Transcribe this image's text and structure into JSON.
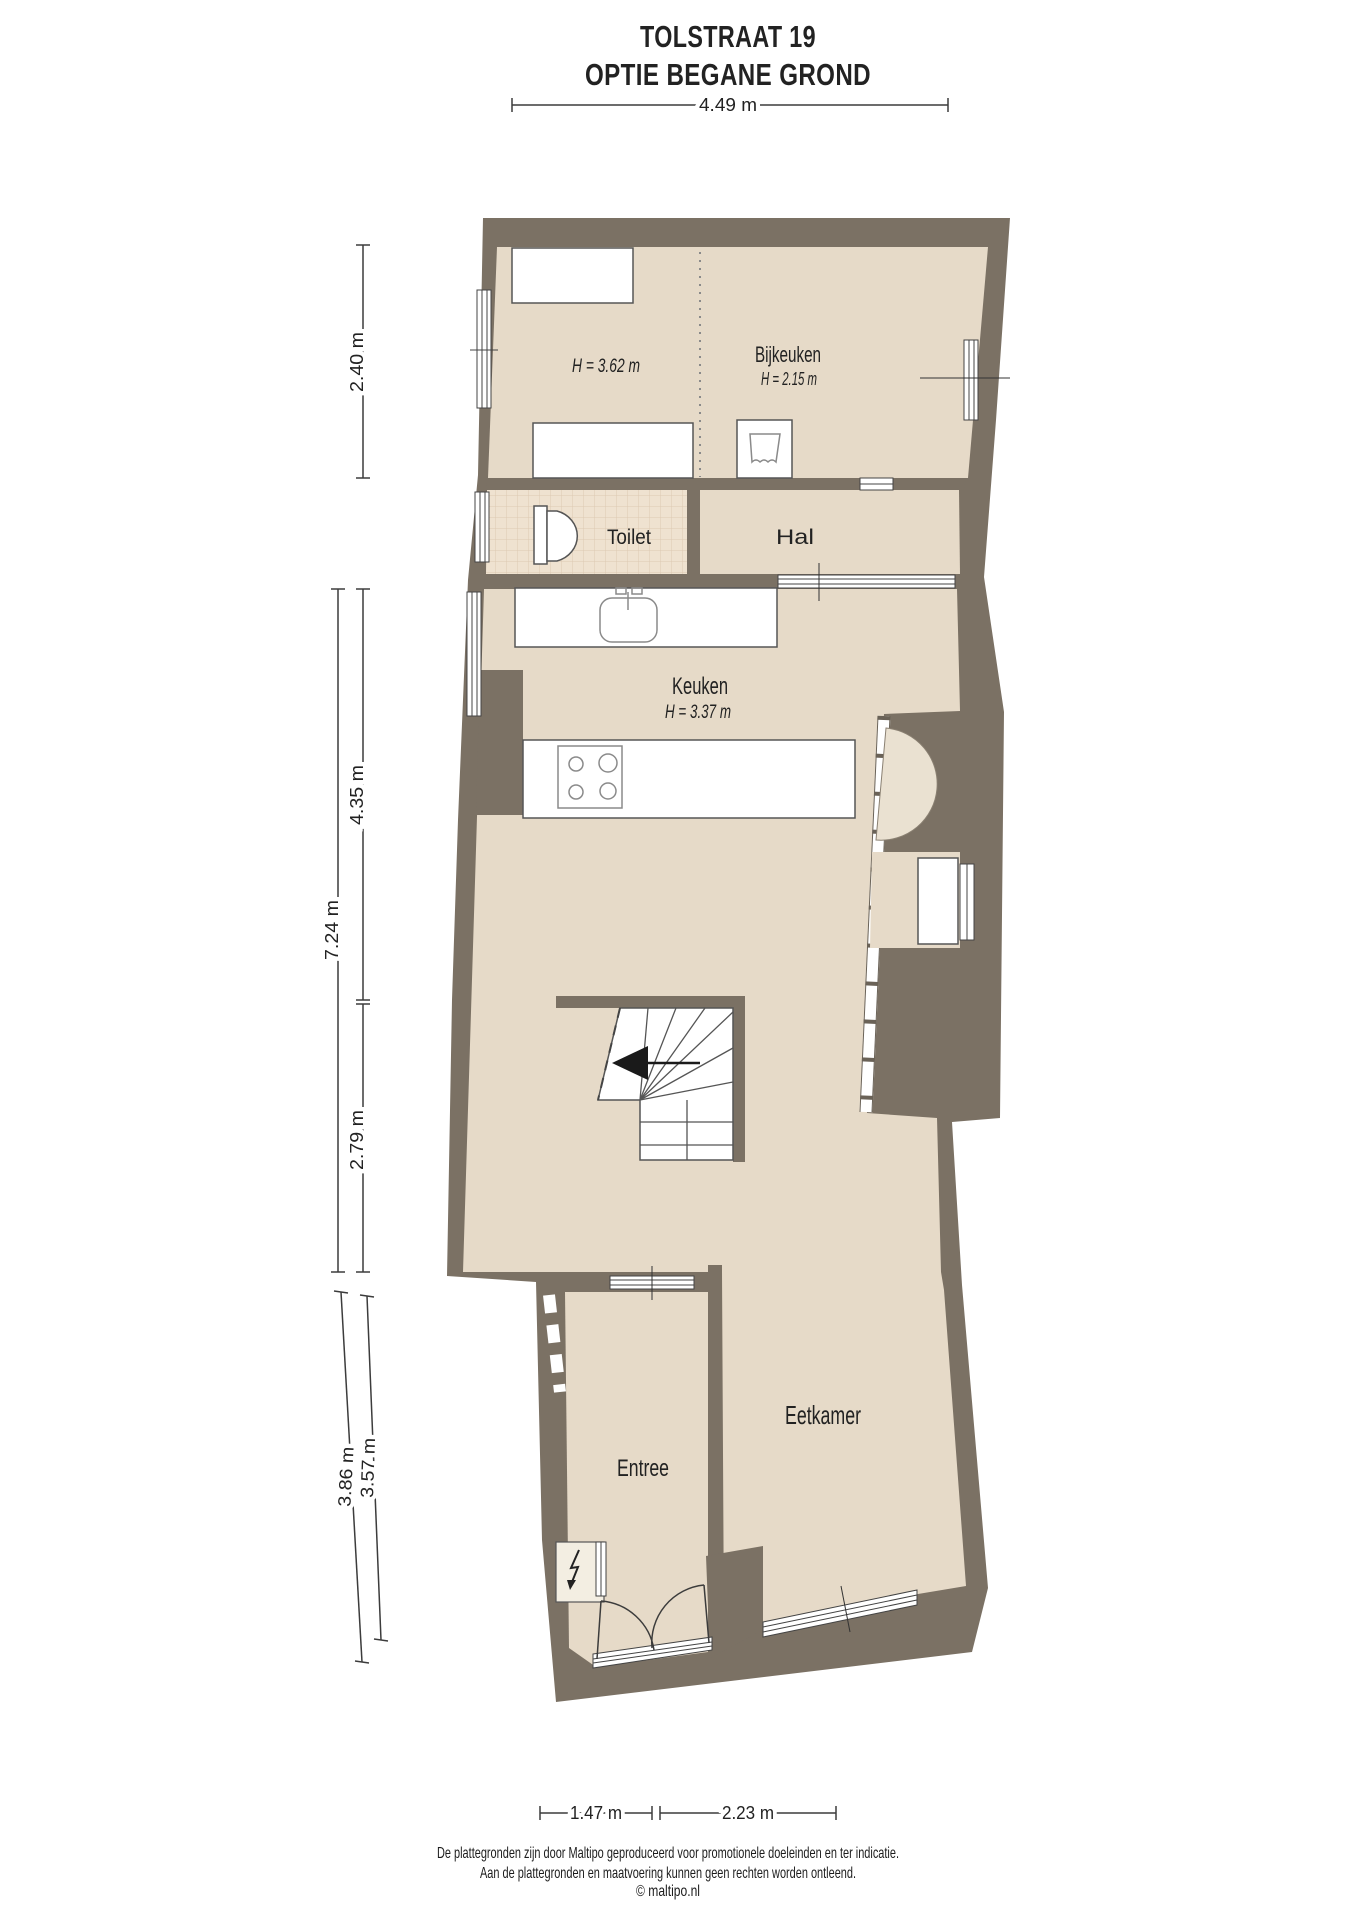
{
  "title": {
    "line1": "TOLSTRAAT 19",
    "line2": "OPTIE BEGANE GROND"
  },
  "rooms": {
    "utility": {
      "height": "H = 3.62 m"
    },
    "bijkeuken": {
      "name": "Bijkeuken",
      "height": "H = 2.15 m"
    },
    "toilet": {
      "name": "Toilet"
    },
    "hal": {
      "name": "Hal"
    },
    "keuken": {
      "name": "Keuken",
      "height": "H = 3.37 m"
    },
    "eetkamer": {
      "name": "Eetkamer"
    },
    "entree": {
      "name": "Entree"
    }
  },
  "dimensions": {
    "top": "4.49 m",
    "left_inner_top": "2.40 m",
    "left_outer": "7.24 m",
    "left_inner_mid": "4.35 m",
    "left_inner_low": "2.79 m",
    "left_outer_bottom": "3.86 m",
    "left_inner_bottom": "3.57 m",
    "bottom_left": "1.47 m",
    "bottom_right": "2.23 m"
  },
  "footer": {
    "line1": "De plattegronden zijn door Maltipo geproduceerd voor promotionele doeleinden en ter indicatie.",
    "line2": "Aan de plattegronden en maatvoering kunnen geen rechten worden ontleend.",
    "line3": "© maltipo.nl"
  },
  "icons": {
    "toilet": "toilet-icon",
    "sink": "sink-icon",
    "stove": "stove-icon",
    "washing_machine": "washing-machine-icon",
    "lightning": "electric-meter-icon",
    "stairs_arrow": "stairs-direction-arrow-icon"
  },
  "colors": {
    "wall": "#7b7164",
    "floor": "#e6dac8",
    "tile": "#efe2d0",
    "niche": "#eae1d1",
    "meter_room": "#f3eee2",
    "text": "#222222"
  }
}
